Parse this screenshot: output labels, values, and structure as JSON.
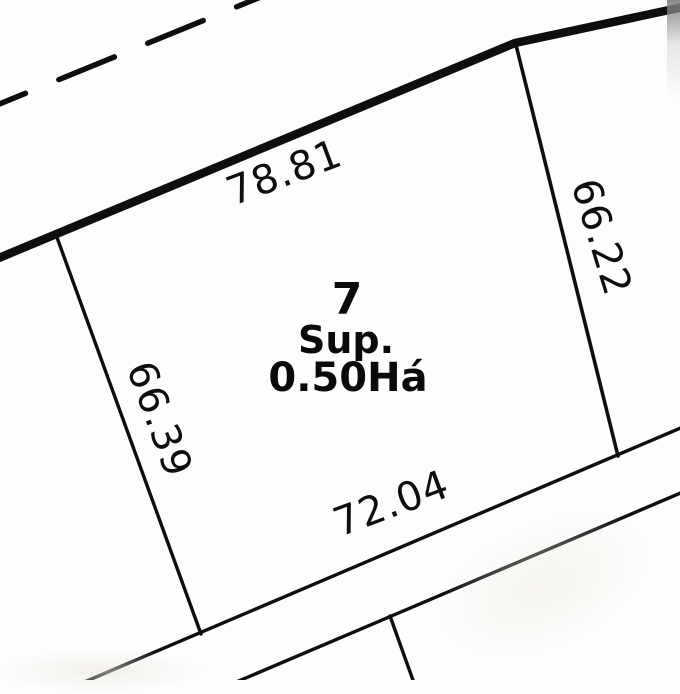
{
  "drawing": {
    "type": "cadastral-parcel-plan",
    "parcel": {
      "number": "7",
      "area_label": "Sup.",
      "area_value": "0.50Há"
    },
    "dimensions": {
      "top": "78.81",
      "right": "66.22",
      "left": "66.39",
      "bottom": "72.04"
    },
    "colors": {
      "line": "#0e0e0e",
      "background": "#fdfdfc"
    }
  }
}
